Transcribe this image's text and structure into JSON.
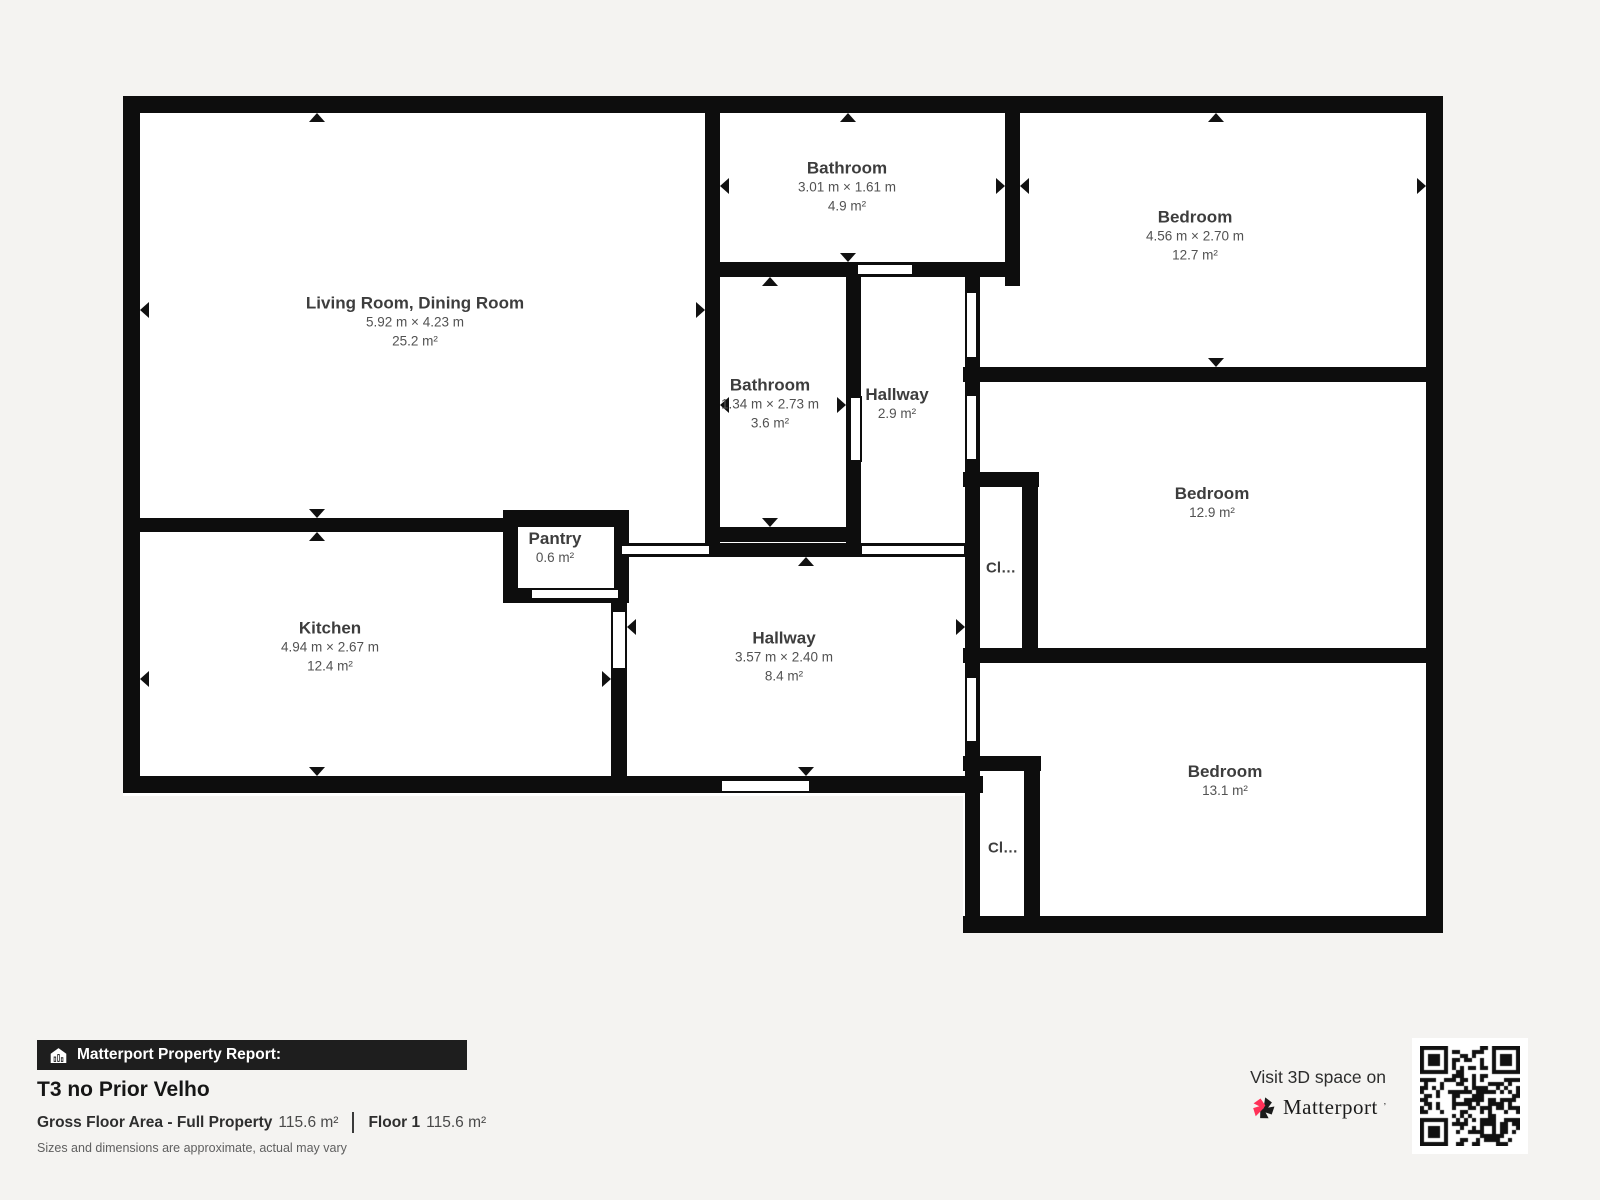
{
  "colors": {
    "page_background": "#f4f3f1",
    "wall": "#0d0d0d",
    "room_fill": "#ffffff",
    "label_title": "#3d3d3d",
    "label_sub": "#525252",
    "report_bar_bg": "#1e1e1e",
    "brand_red": "#ff3158",
    "brand_black": "#1b1b1b"
  },
  "plan": {
    "rooms": [
      {
        "id": "living",
        "name": "Living Room, Dining Room",
        "dims": "5.92 m × 4.23 m",
        "area": "25.2 m²"
      },
      {
        "id": "bathroom-top",
        "name": "Bathroom",
        "dims": "3.01 m × 1.61 m",
        "area": "4.9 m²"
      },
      {
        "id": "bedroom-top",
        "name": "Bedroom",
        "dims": "4.56 m × 2.70 m",
        "area": "12.7 m²"
      },
      {
        "id": "bathroom-mid",
        "name": "Bathroom",
        "dims": "1.34 m × 2.73 m",
        "area": "3.6 m²"
      },
      {
        "id": "hallway-small",
        "name": "Hallway",
        "dims": "",
        "area": "2.9 m²"
      },
      {
        "id": "bedroom-mid",
        "name": "Bedroom",
        "dims": "",
        "area": "12.9 m²"
      },
      {
        "id": "pantry",
        "name": "Pantry",
        "dims": "",
        "area": "0.6 m²"
      },
      {
        "id": "kitchen",
        "name": "Kitchen",
        "dims": "4.94 m × 2.67 m",
        "area": "12.4 m²"
      },
      {
        "id": "hallway-main",
        "name": "Hallway",
        "dims": "3.57 m × 2.40 m",
        "area": "8.4 m²"
      },
      {
        "id": "bedroom-bottom",
        "name": "Bedroom",
        "dims": "",
        "area": "13.1 m²"
      },
      {
        "id": "closet-upper",
        "name": "Cl…",
        "dims": "",
        "area": ""
      },
      {
        "id": "closet-lower",
        "name": "Cl…",
        "dims": "",
        "area": ""
      }
    ]
  },
  "report": {
    "bar_label": "Matterport Property Report:",
    "property_title": "T3 no Prior Velho",
    "gross_label": "Gross Floor Area - Full Property",
    "gross_value": "115.6 m²",
    "floor_label": "Floor 1",
    "floor_value": "115.6 m²",
    "disclaimer": "Sizes and dimensions are approximate, actual may vary"
  },
  "cta": {
    "visit_text": "Visit 3D space on",
    "brand": "Matterport",
    "brand_mark": "’"
  }
}
